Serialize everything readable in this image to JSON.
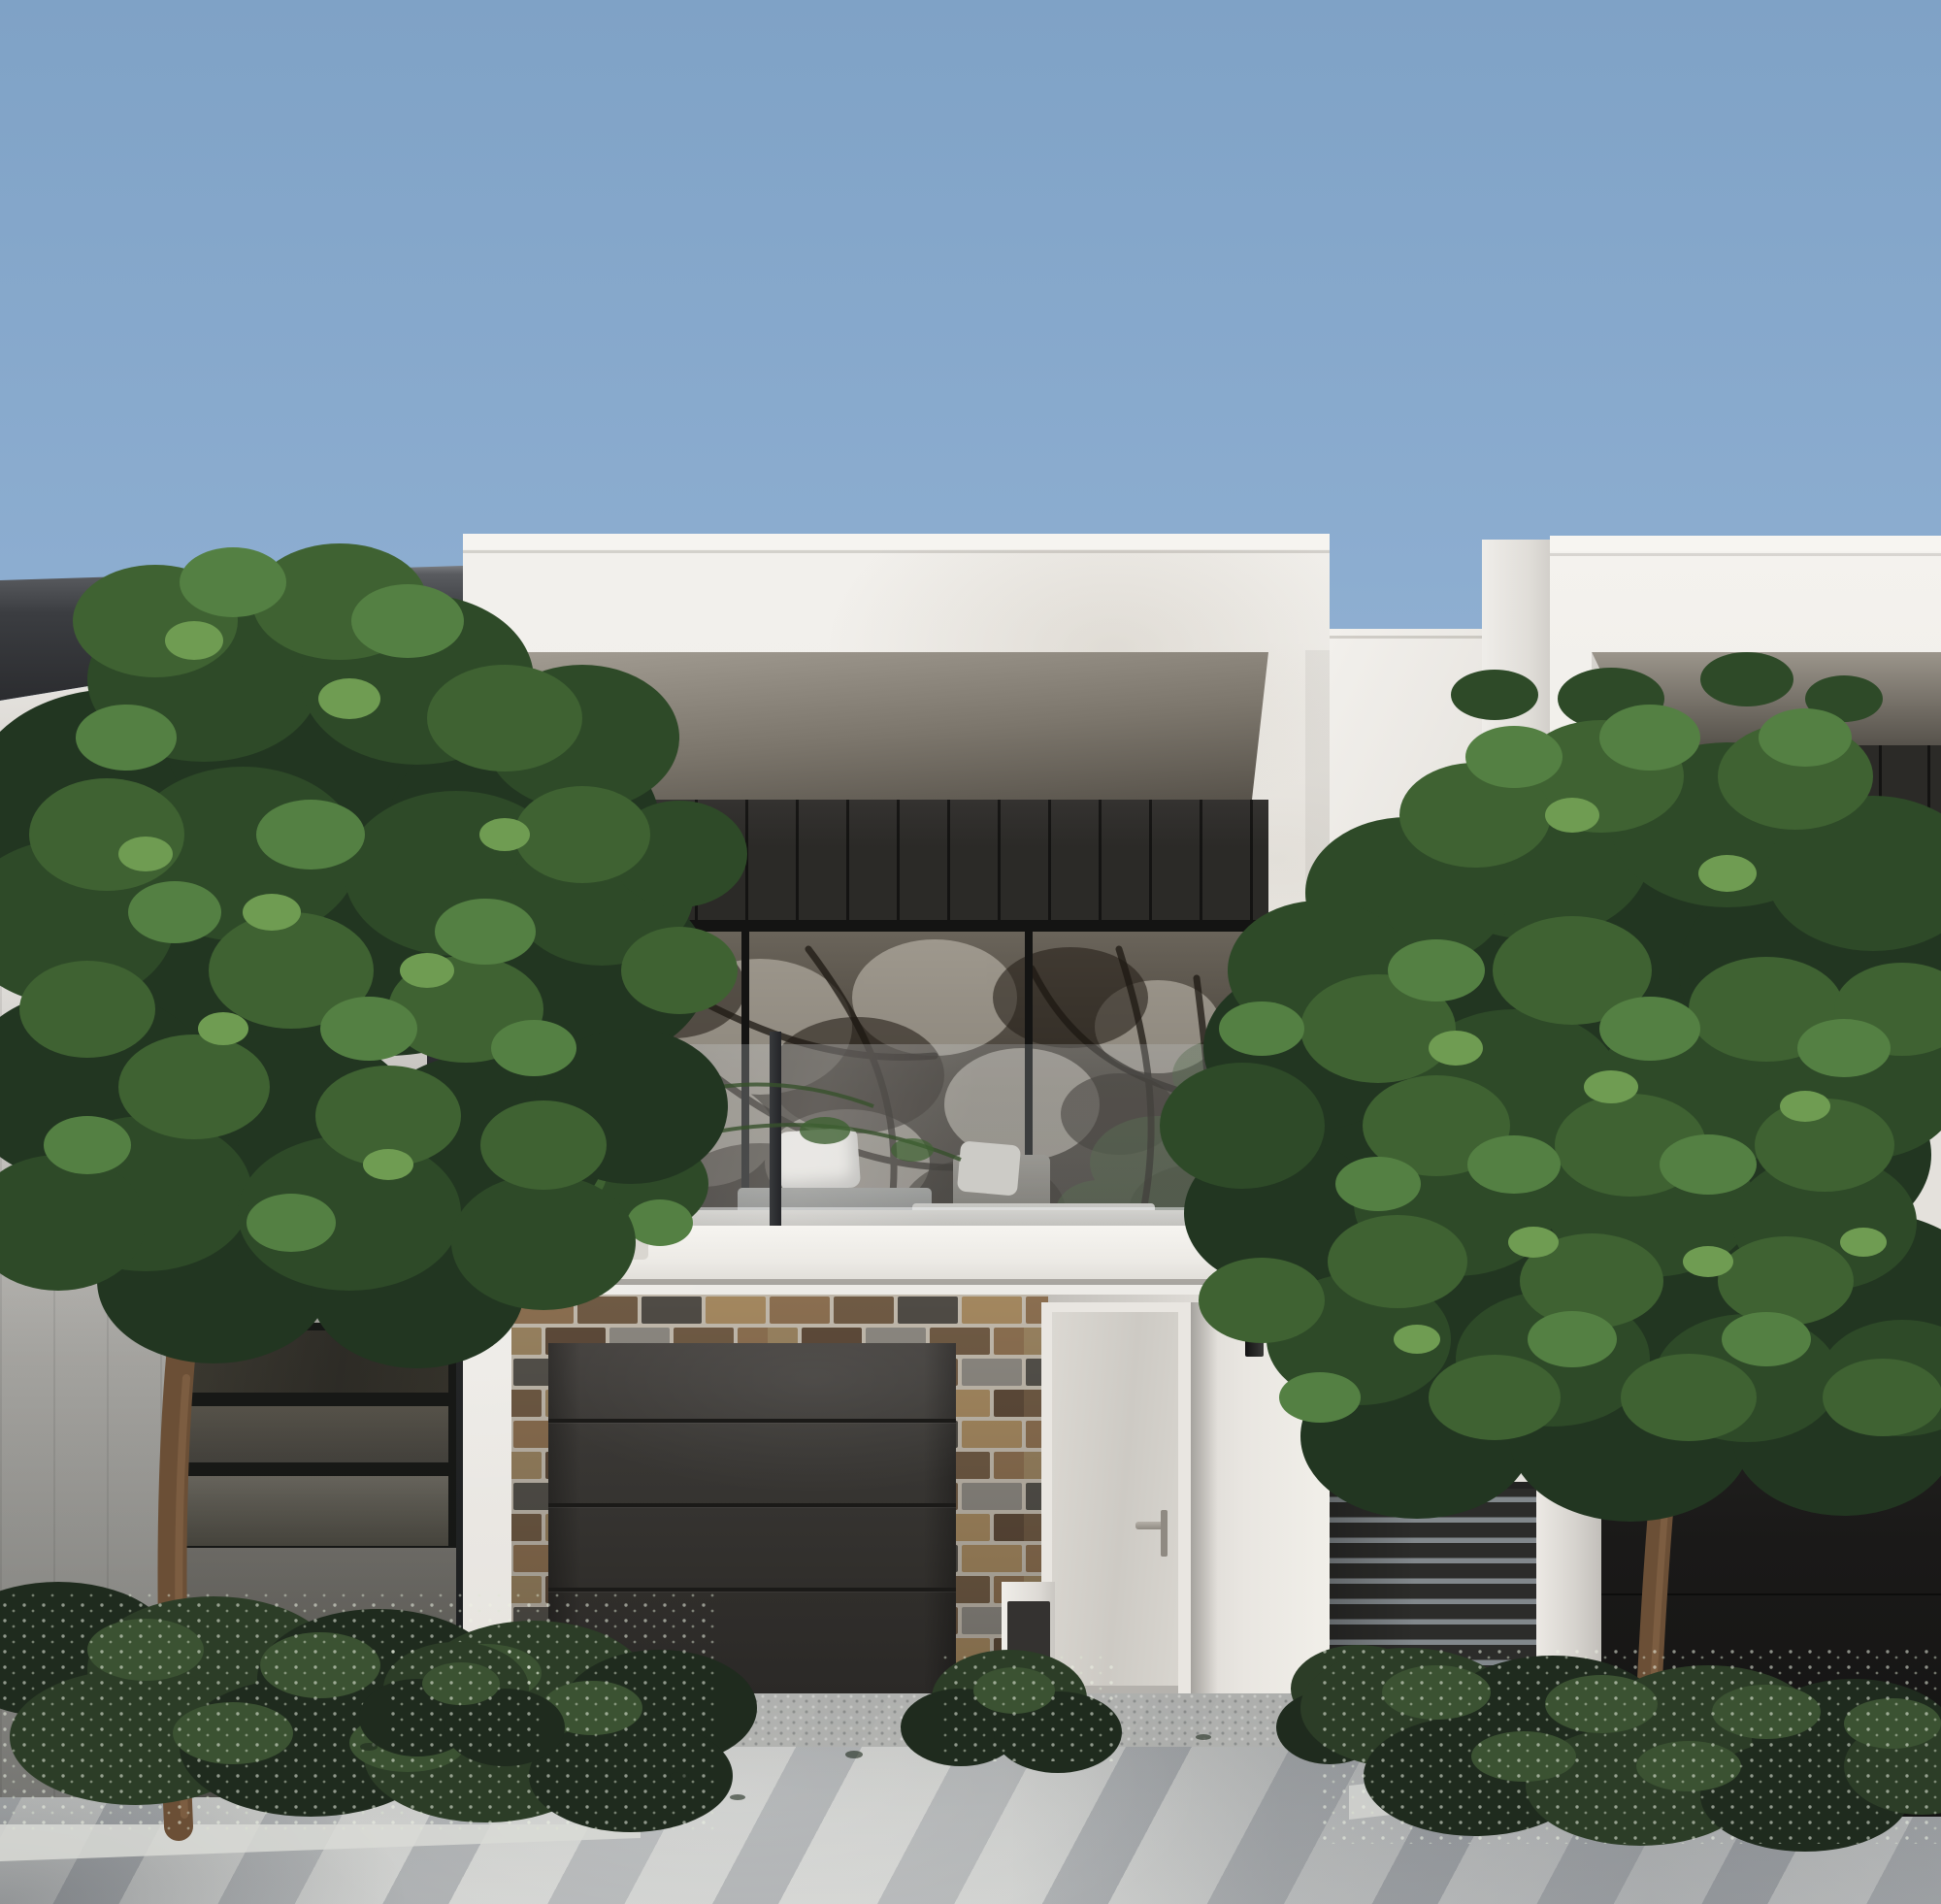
{
  "scene": {
    "type": "architectural-exterior-render",
    "subject": "modern two-storey townhouse street facade with neighbouring townhouses",
    "time_of_day": "clear daytime, sunlight from upper left",
    "elements": {
      "sky": "clear gradient blue sky",
      "left_house": "neighbour with dark charcoal fascia, white vertical cladding, horizontal windows, bedroom window at ground floor",
      "center_house": "white rendered townhouse with recessed first-floor balcony, dark vertical cladding, glass balustrade, outdoor sofa and potted plant, brick garage surround, dark sectional garage door, recessed entry with light door and wall sconces, letterbox",
      "connector_wall": "lower white wall with narrow three-pane window between houses",
      "right_house": "neighbour with matching recessed balcony, dark slat fence, white pier and dark garage",
      "landscape": "street trees left and right, low flowering shrubs in garden beds, concrete driveway with tree shadows"
    }
  },
  "colors": {
    "sky_top": "#7fa2c6",
    "sky_low": "#aac5e0",
    "wall_white": "#efede9",
    "wall_shadow": "#cfccc7",
    "fascia": "#3b3d41",
    "clad_dark": "#2b2a27",
    "soffit_light": "#a29c92",
    "soffit_dark": "#57524a",
    "frame_black": "#161615",
    "rail": "#2f3033",
    "pillow": "#e9e6e0",
    "garage": "#393734",
    "seam": "#1b1a18",
    "door": "#cdcac4",
    "door_frame": "#e9e6e1",
    "handle": "#8f8a82",
    "fence_slat": "#2c2c2a",
    "fence_gap": "#82888c",
    "rgarage": "#1a1918",
    "pave": "#c9cac7",
    "pave_light": "#d8d9d6",
    "brick_mortar": "#c0b8ab",
    "foliage_1": "#223621",
    "foliage_2": "#2e4a28",
    "foliage_3": "#3f6232",
    "foliage_4": "#548043",
    "foliage_5": "#6f9c52",
    "shrub_1": "#1f2b1e",
    "shrub_2": "#2c3d27",
    "shrub_3": "#3b5232",
    "trunk": "#6b4f36",
    "trunk_light": "#8a6a4a"
  }
}
